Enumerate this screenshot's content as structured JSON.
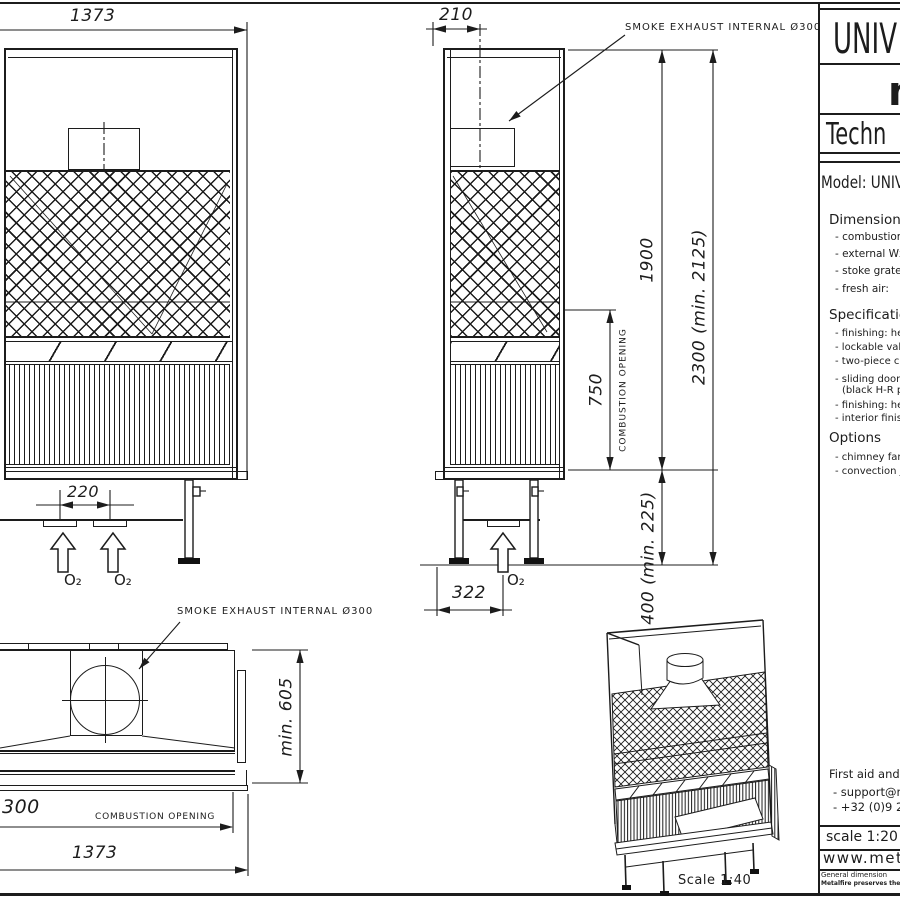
{
  "colors": {
    "line": "#1c1c1c",
    "background": "#ffffff"
  },
  "views": {
    "front": {
      "width_dim": "1373",
      "inlet_spacing_dim": "220",
      "o2_label": "O₂"
    },
    "side": {
      "depth_dim": "210",
      "smoke_exhaust_label": "SMOKE EXHAUST INTERNAL Ø300",
      "opening_height_dim": "750",
      "opening_label": "COMBUSTION OPENING",
      "height_dim": "1900",
      "total_height_dim": "2300 (min. 2125)",
      "leg_height_dim": "400 (min. 225)",
      "base_depth_dim": "322",
      "o2_label": "O₂"
    },
    "top": {
      "smoke_exhaust_label": "SMOKE EXHAUST INTERNAL Ø300",
      "depth_dim": "min. 605",
      "opening_width_dim": "300",
      "opening_label": "COMBUSTION OPENING",
      "width_dim": "1373"
    },
    "iso": {
      "scale_label": "Scale 1:40"
    }
  },
  "title_block": {
    "brand": "UNIV",
    "logo": "m",
    "doc_type": "Techn",
    "model": "Model: UNIVE",
    "dimensions_heading": "Dimensions",
    "dimensions_items": [
      "- combustion o",
      "- external WxD",
      "- stoke grate W",
      "- fresh air:"
    ],
    "specification_heading": "Specification",
    "specification_items": [
      "- finishing: hea",
      "- lockable valv",
      "- two-piece ca",
      "- sliding door i",
      "(black H-R p",
      "- finishing: hea",
      "- interior finishi"
    ],
    "options_heading": "Options",
    "options_items": [
      "- chimney fan",
      "- convection j"
    ],
    "contact_line1": "First aid and",
    "contact_line2": "- support@me",
    "contact_line3": "- +32 (0)9 2",
    "scale_label": "scale 1:20",
    "website": "www.met",
    "footer_line1": "General dimension",
    "footer_line2": "Metalfire preserves the ri"
  }
}
